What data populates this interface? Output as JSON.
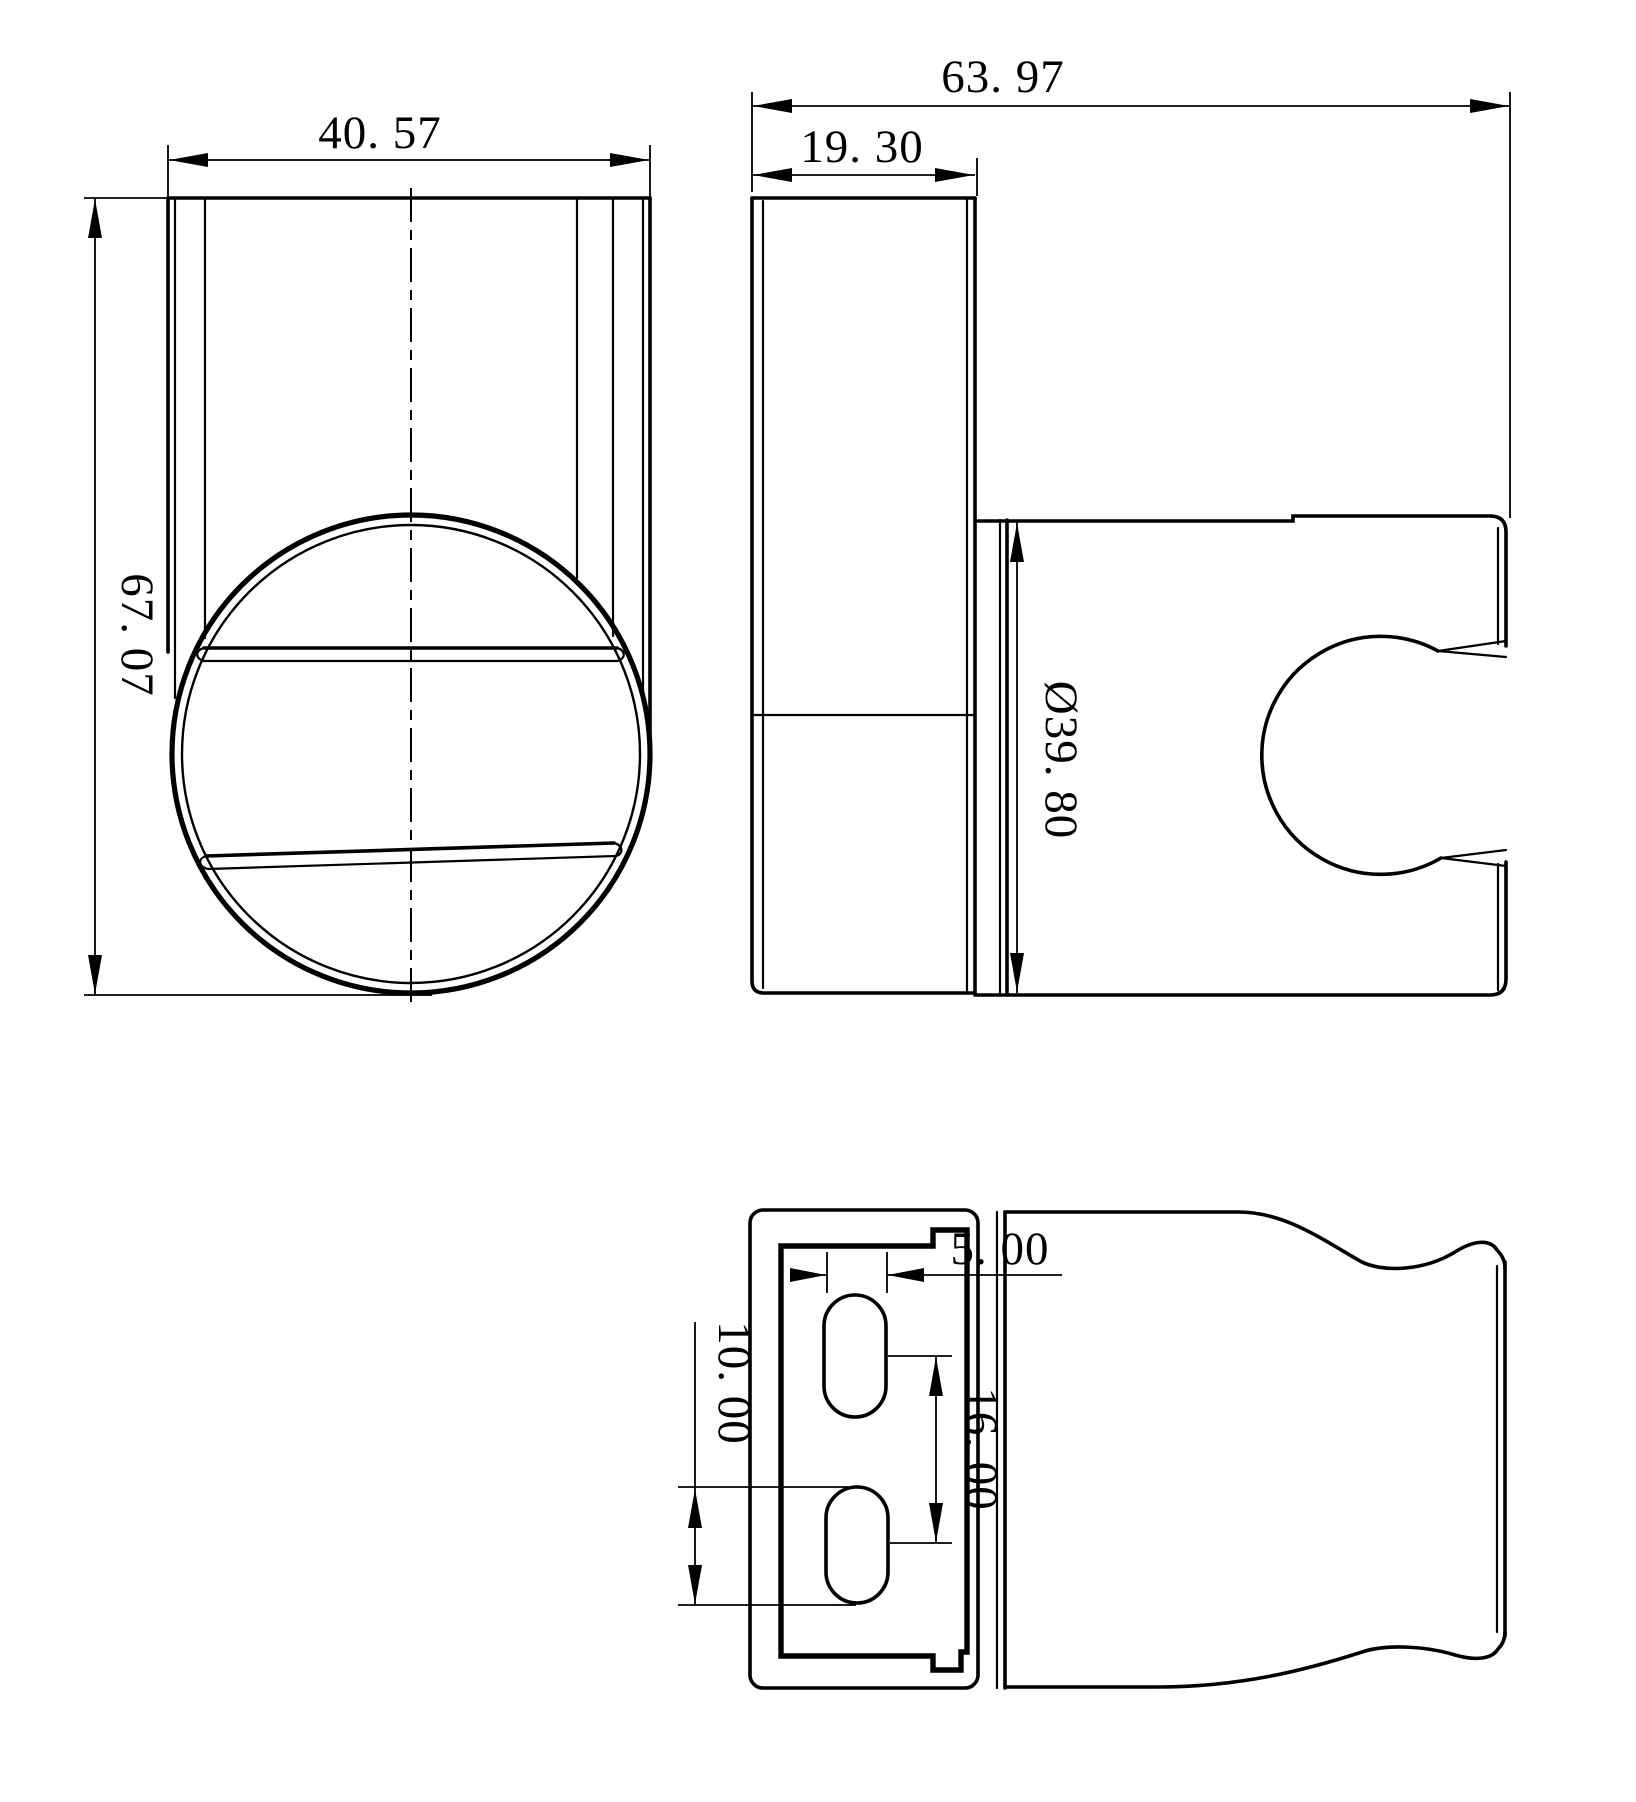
{
  "page": {
    "background_color": "#ffffff",
    "line_color": "#000000",
    "kind": "engineering-drawing",
    "subject": "wall-mounted shower head holder bracket, three orthographic views"
  },
  "drawing": {
    "views": {
      "front": {
        "dims": {
          "width": {
            "label": "40. 57",
            "value": 40.57
          },
          "height": {
            "label": "67. 07",
            "value": 67.07
          }
        }
      },
      "side": {
        "dims": {
          "total_depth": {
            "label": "63. 97",
            "value": 63.97
          },
          "plate_depth": {
            "label": "19. 30",
            "value": 19.3
          },
          "cup_diameter": {
            "label": "Ø39. 80",
            "value": 39.8
          }
        }
      },
      "bottom": {
        "dims": {
          "slot_width": {
            "label": "5. 00",
            "value": 5.0
          },
          "slot_length": {
            "label": "10. 00",
            "value": 10.0
          },
          "slot_spacing": {
            "label": "16. 00",
            "value": 16.0
          }
        }
      }
    }
  }
}
